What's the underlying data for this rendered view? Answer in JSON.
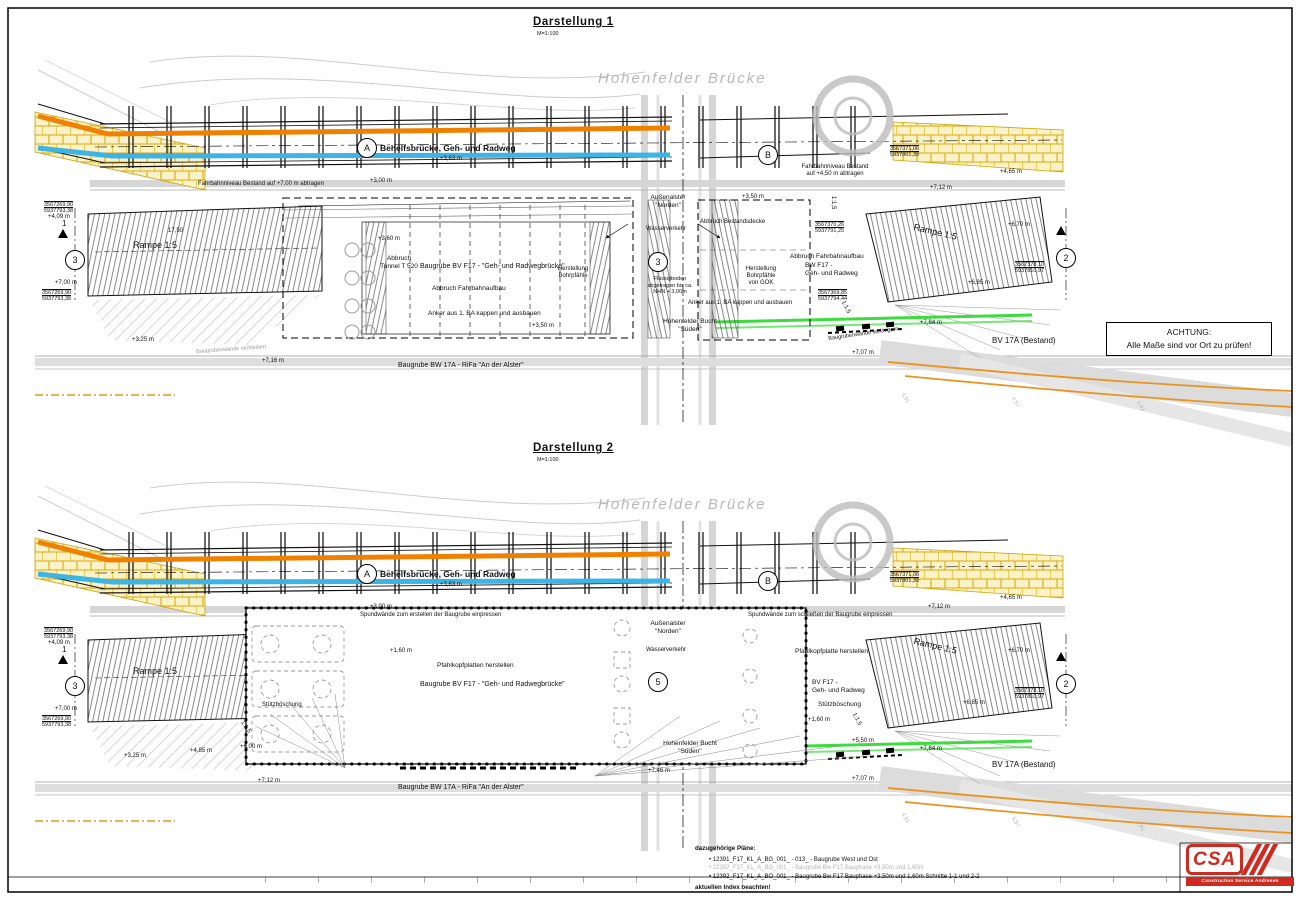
{
  "frame": {
    "attention1": "ACHTUNG:",
    "attention2": "Alle Maße sind vor Ort zu prüfen!"
  },
  "common": {
    "scale": "M=1:100",
    "bridge_name": "Hohenfelder Brücke",
    "behelfsbruecke": "Behelfsbrücke, Geh- und Radweg",
    "marker_a": "A",
    "marker_b": "B",
    "axis_1": "1",
    "axis_2": "2",
    "axis_3": "3",
    "axis_5": "5",
    "rampe": "Rampe 1:5",
    "dim_1750": "17,50",
    "bv17a": "BV 17A (Bestand)",
    "baugrube_alster": "Baugrube   BW 17A  -  RiFa \"An der Alster\"",
    "aussenalster1": "Außenalster",
    "aussenalster2": "\"Norden\"",
    "wasserverkehr": "Wasserverkehr",
    "bucht1": "Hohenfelder Bucht",
    "bucht2": "\"Süden\"",
    "slope115": "1:1,5",
    "anker": "Anker aus 1. BA kappen und ausbauen",
    "verlaengern": "Baugrubenwände verlängern",
    "verbleiben": "Baugrubenwände verbleiben",
    "elev_409": "+4,09 m",
    "elev_700": "+7,00 m",
    "elev_325": "+3,25 m",
    "elev_465": "+4,65 m",
    "elev_712": "+7,12 m",
    "elev_670": "+6,70 m",
    "elev_685": "+6,85 m",
    "elev_764": "+7,64 m",
    "elev_707": "+7,07 m",
    "elev_350": "+3,50 m",
    "elev_160": "+1,60 m",
    "elev_360": "+3,60 m",
    "elev_300": "+3,00 m",
    "elev_363": "+3,63 m",
    "elev_716": "+7,16 m",
    "elev_485": "+4,85 m",
    "elev_600": "+6,00 m",
    "elev_746": "+7,46 m",
    "elev_550": "+5,50 m",
    "coord1a": "3567269,90",
    "coord1b": "5937793,38",
    "coord2a": "3567371,06",
    "coord2b": "5937801,39",
    "coord3a": "3567370,26",
    "coord3b": "5937791,25",
    "coord4a": "3567369,85",
    "coord4b": "5937794,44",
    "coord5a": "3567378,10",
    "coord5b": "5937810,97"
  },
  "view1": {
    "title": "Darstellung 1",
    "labels": {
      "abtragen_left": "Fahrbahnniveau Bestand auf +7,00 m abtragen",
      "abtragen_right1": "Fahrbahnniveau Bestand",
      "abtragen_right2": "auf +4,50 m abtragen",
      "abbruch1": "Abbruch",
      "abbruch2": "Tunnel T 520",
      "baugrube_f17": "Baugrube   BV F17  -  \"Geh- und Radwegbrücke\"",
      "abbruch_fahrbahn": "Abbruch Fahrbahnaufbau",
      "herstellung1": "Herstellung",
      "herstellung2": "Bohrpfähle",
      "abbruch_bestandsdecke": "Abbruch Bestandsdecke",
      "bw_f17a": "BW F17 -",
      "bw_f17b": "Geh- und Radweg",
      "gok1": "Herstellung",
      "gok2": "Bohrpfähle",
      "gok3": "von GOK",
      "fluess1": "Flüssigboden",
      "fluess2": "abgetragen bis ca.",
      "fluess3": "NHN + 3,00m"
    }
  },
  "view2": {
    "title": "Darstellung 2",
    "labels": {
      "spund_erstellen": "Spundwände zum erstellen der Baugrube einpressen",
      "spund_schliessen": "Spundwände zum schließen der Baugrube einpressen",
      "pfahlkopfplatten": "Pfahlkopfplatten herstellen",
      "pfahlkopfplatte": "Pfahlkopfplatte herstellen",
      "baugrube_f17": "Baugrube   BV F17  -  \"Geh- und Radwegbrücke\"",
      "bv_f17a": "BV F17 -",
      "bv_f17b": "Geh- und Radweg",
      "stuetzboeschung": "Stützböschung"
    }
  },
  "soundings": [
    "4,51",
    "4,57",
    "4,63"
  ],
  "footer": {
    "bullet": "•",
    "plans_title": "dazugehörige Pläne:",
    "plan_1": "12391_F17_KL_A_BG_001_  -  013_  -  Baugrube West und Ost",
    "plan_2": "12392_F17_KL_A_BG_001_  -  Baugrube Bw F17 Bauphase +3,50m und 1,60m",
    "plan_3": "12392_F17_KL_A_BO_001_  -  Baugrube Bw F17 Bauphase +3,50m und 1,60m  Schnitte 1-1 und 2-2",
    "note": "aktuellen Index beachten!"
  },
  "logo": {
    "name": "CSA",
    "subtitle": "Construction Service Andresen"
  },
  "colors": {
    "orange_line": "#f08100",
    "blue_line": "#3cb4e5",
    "green_line": "#3ddc3d",
    "yellow_hatch": "#d8ab0a",
    "logo_red": "#cf2a1f"
  }
}
